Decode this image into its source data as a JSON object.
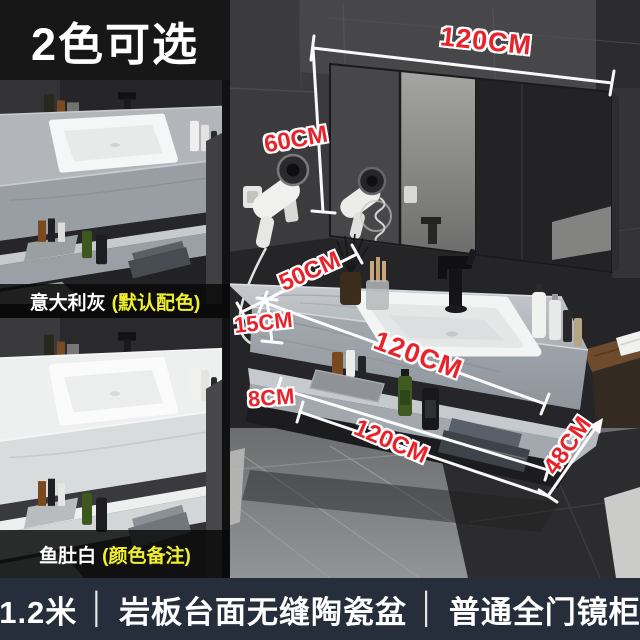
{
  "badge": {
    "label": "2色可选"
  },
  "variants": [
    {
      "name": "意大利灰",
      "note": "(默认配色)"
    },
    {
      "name": "鱼肚白",
      "note": "(颜色备注)"
    }
  ],
  "dimensions": {
    "mirror_width": "120CM",
    "mirror_height": "60CM",
    "counter_depth": "50CM",
    "counter_thickness": "15CM",
    "counter_width": "120CM",
    "shelf_thickness": "8CM",
    "shelf_width": "120CM",
    "cabinet_depth": "48CM"
  },
  "caption": {
    "parts": [
      "1.2米",
      "岩板台面无缝陶瓷盆",
      "普通全门镜柜"
    ],
    "divider": "│"
  },
  "colors": {
    "dimension_red": "#e8232b",
    "caption_bg": "#272e3b",
    "note_yellow": "#f0ef2f",
    "badge_bg": "#171717"
  }
}
